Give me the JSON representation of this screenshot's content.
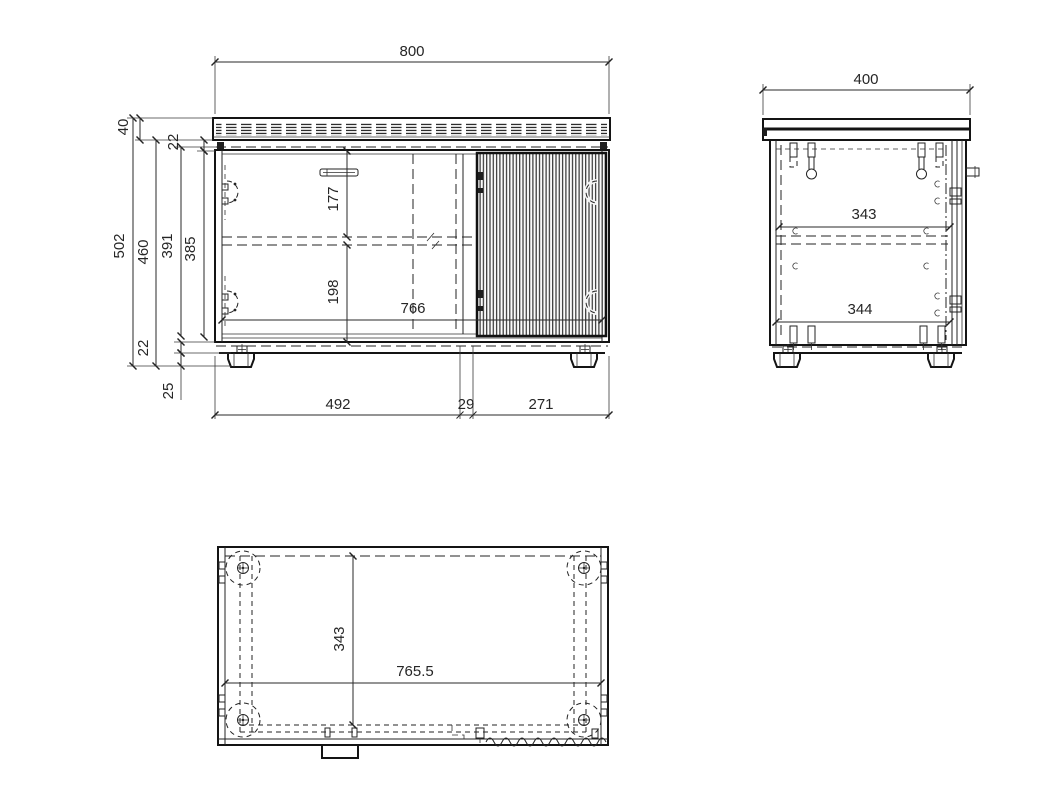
{
  "drawing": {
    "type": "technical-orthographic-furniture-drawing",
    "background": "#ffffff",
    "line_color": "#232323",
    "text_color": "#262626",
    "views": {
      "front": {
        "label": "front-view",
        "dims": {
          "overall_width": "800",
          "top_panel_height": "40",
          "top_board_thickness": "22",
          "overall_height": "502",
          "body_height": "460",
          "inner_height_back": "391",
          "inner_height": "385",
          "top_to_shelf": "177",
          "shelf_to_bottom": "198",
          "inner_width": "766",
          "bottom_board_thickness": "22",
          "foot_height": "25",
          "left_section_width": "492",
          "divider_width": "29",
          "right_section_width": "271"
        }
      },
      "side": {
        "label": "side-view",
        "dims": {
          "overall_depth": "400",
          "inner_depth_upper": "343",
          "inner_depth_lower": "344"
        }
      },
      "bottom": {
        "label": "bottom-view",
        "dims": {
          "inner_depth": "343",
          "inner_width": "765.5"
        }
      }
    }
  }
}
